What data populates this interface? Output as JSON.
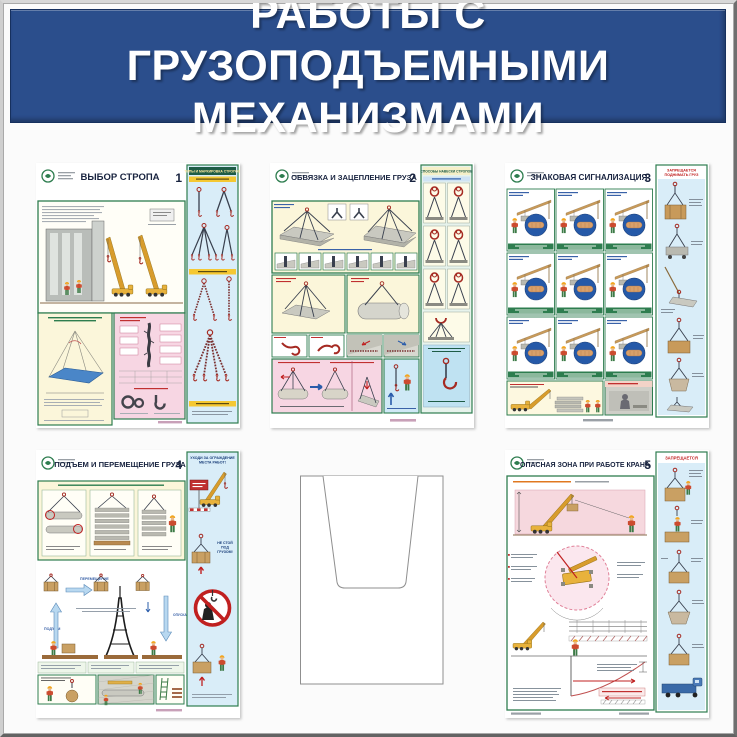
{
  "banner": {
    "line1": "РАБОТЫ С ГРУЗОПОДЪЕМНЫМИ",
    "line2": "МЕХАНИЗМАМИ"
  },
  "posters": {
    "p1": {
      "number": "1",
      "title": "ВЫБОР СТРОПА",
      "col_header": "ТИПЫ И МАРКИРОВКА СТРОПОВ"
    },
    "p2": {
      "number": "2",
      "title": "ОБВЯЗКА И ЗАЦЕПЛЕНИЕ ГРУЗА",
      "col_header": "СПОСОБЫ НАВЕСКИ СТРОПОВ"
    },
    "p3": {
      "number": "3",
      "title": "ЗНАКОВАЯ СИГНАЛИЗАЦИЯ",
      "col_header_line1": "ЗАПРЕЩАЕТСЯ",
      "col_header_line2": "ПОДНИМАТЬ ГРУЗ"
    },
    "p4": {
      "number": "4",
      "title": "ПОДЪЕМ И ПЕРЕМЕЩЕНИЕ ГРУЗА",
      "col_header_line1": "УХОДИ ЗА ОГРАЖДЕНИЕ",
      "col_header_line2": "МЕСТА РАБОТ!",
      "col_caption_line1": "НЕ СТОЙ",
      "col_caption_line2": "ПОД",
      "col_caption_line3": "ГРУЗОМ!",
      "labels": {
        "move": "ПЕРЕМЕЩЕНИЕ",
        "lower": "ОПУСКАНИЕ",
        "raise": "ПОДЪЕМ"
      }
    },
    "p5": {
      "number": "5",
      "title": "ОПАСНАЯ ЗОНА ПРИ РАБОТЕ КРАНА",
      "col_header": "ЗАПРЕЩАЕТСЯ"
    }
  },
  "colors": {
    "banner_bg": "#2b4e8c",
    "banner_text": "#ffffff",
    "poster_frame_green": "#2e7d4f",
    "section_yellow": "#fbf6da",
    "section_pink": "#f7d6e3",
    "column_blue": "#d9edf8",
    "crane_yellow": "#e8b23c",
    "hook_red": "#a52a22",
    "signal_circle_blue": "#2559a8",
    "prohibition_red": "#c02020"
  }
}
